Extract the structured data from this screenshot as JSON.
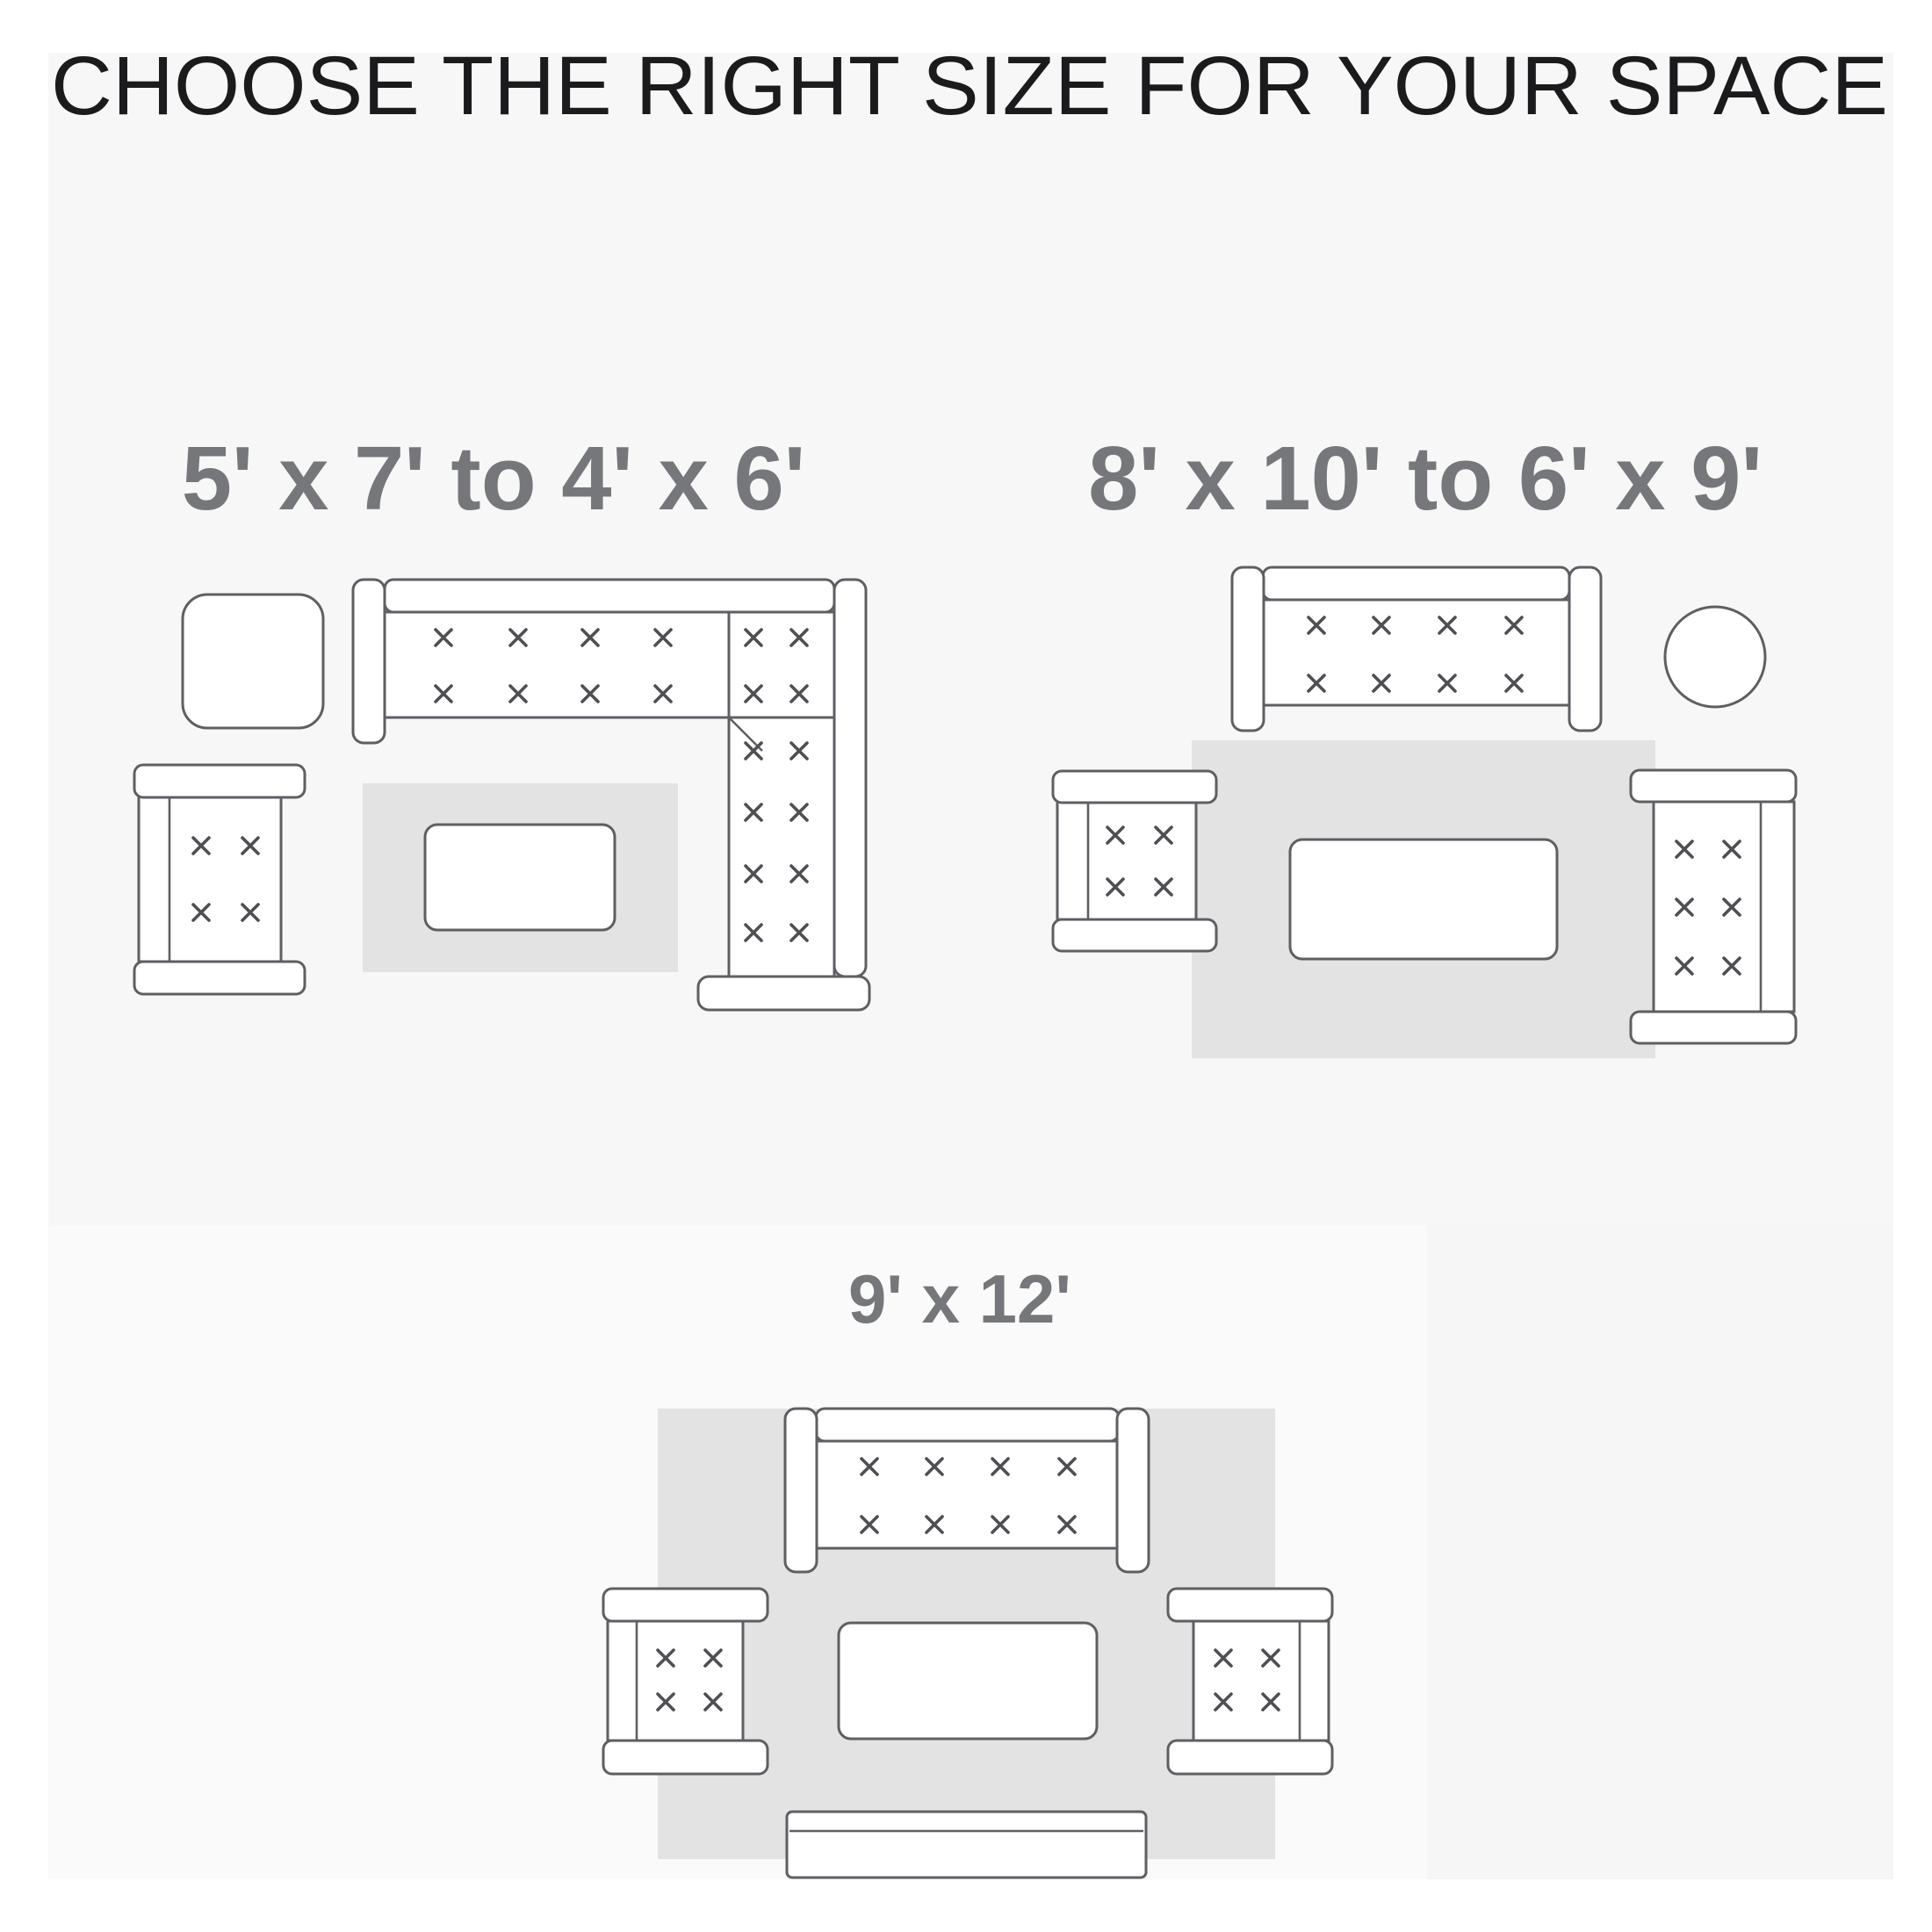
{
  "title": "CHOOSE THE RIGHT SIZE FOR YOUR SPACE",
  "diagrams": [
    {
      "id": "small",
      "label": "5' x 7' to 4' x 6'"
    },
    {
      "id": "medium",
      "label": "8' x 10' to 6' x 9'"
    },
    {
      "id": "large",
      "label": "9' x 12'"
    }
  ],
  "colors": {
    "page_background": "#ffffff",
    "panel_top": "#f7f7f7",
    "panel_bottom_left": "#fafafa",
    "panel_bottom_right": "#f6f6f6",
    "rug": "#e3e3e3",
    "furniture_fill": "#ffffff",
    "furniture_outline": "#5e5f63",
    "tuft_mark": "#4e4e53",
    "title_text": "#1b1b1d",
    "label_text": "#76777a"
  }
}
